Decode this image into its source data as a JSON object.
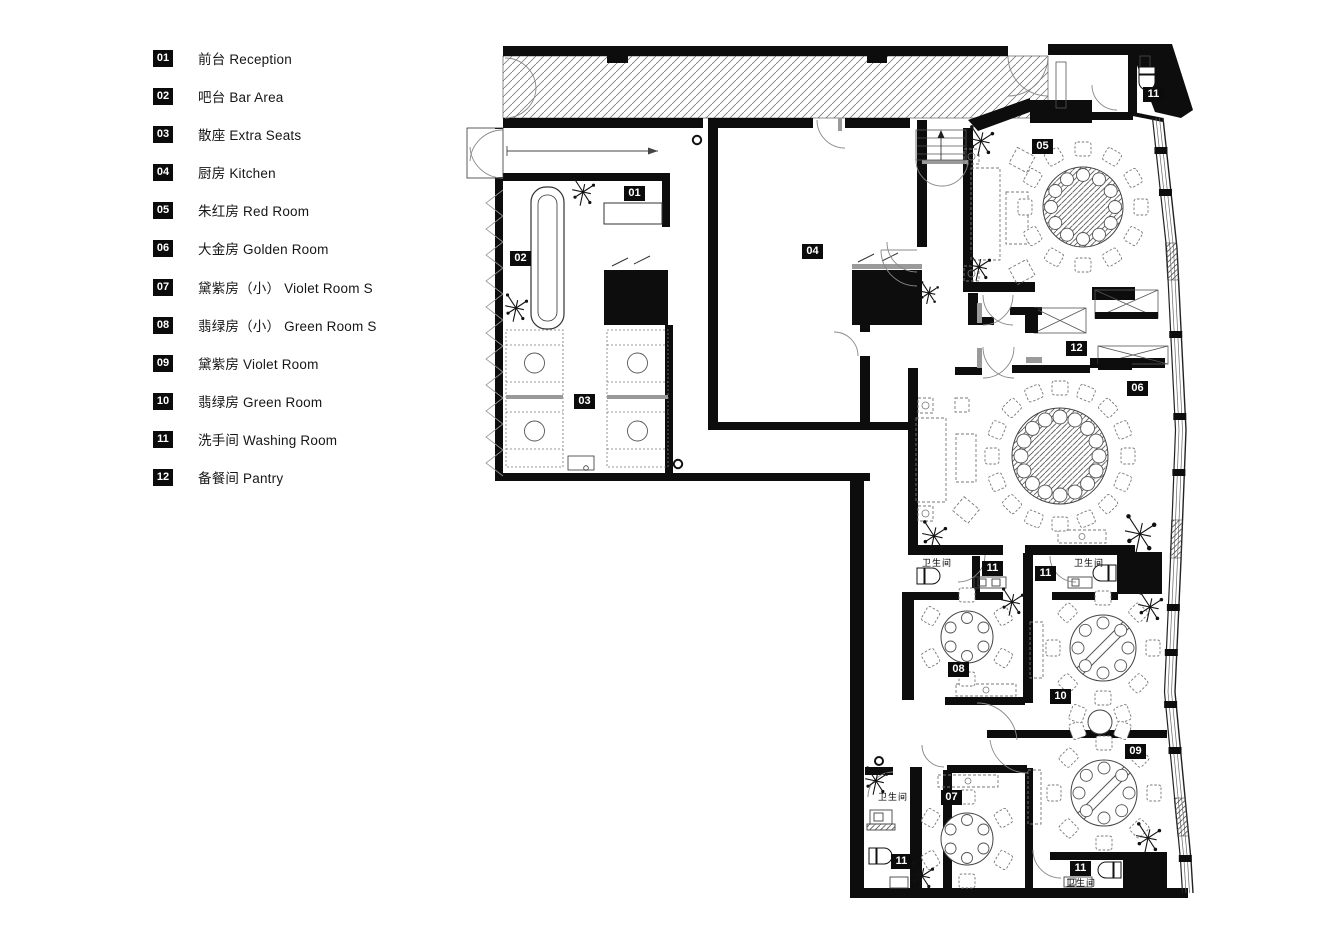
{
  "legend": {
    "items": [
      {
        "num": "01",
        "label": "前台 Reception"
      },
      {
        "num": "02",
        "label": "吧台 Bar Area"
      },
      {
        "num": "03",
        "label": "散座 Extra Seats"
      },
      {
        "num": "04",
        "label": "厨房 Kitchen"
      },
      {
        "num": "05",
        "label": "朱红房 Red Room"
      },
      {
        "num": "06",
        "label": "大金房 Golden Room"
      },
      {
        "num": "07",
        "label": "黛紫房（小） Violet Room S"
      },
      {
        "num": "08",
        "label": "翡绿房（小） Green Room S"
      },
      {
        "num": "09",
        "label": "黛紫房 Violet Room"
      },
      {
        "num": "10",
        "label": "翡绿房 Green Room"
      },
      {
        "num": "11",
        "label": "洗手间 Washing Room"
      },
      {
        "num": "12",
        "label": "备餐间 Pantry"
      }
    ]
  },
  "plan": {
    "badges": [
      {
        "id": "reception",
        "label": "01"
      },
      {
        "id": "bar-area",
        "label": "02"
      },
      {
        "id": "extra-seats",
        "label": "03"
      },
      {
        "id": "kitchen",
        "label": "04"
      },
      {
        "id": "red-room",
        "label": "05"
      },
      {
        "id": "golden-room",
        "label": "06"
      },
      {
        "id": "violet-room-s",
        "label": "07"
      },
      {
        "id": "green-room-s",
        "label": "08"
      },
      {
        "id": "violet-room",
        "label": "09"
      },
      {
        "id": "green-room",
        "label": "10"
      },
      {
        "id": "washing-room-ne",
        "label": "11"
      },
      {
        "id": "washing-room-mid-left",
        "label": "11"
      },
      {
        "id": "washing-room-mid-right",
        "label": "11"
      },
      {
        "id": "washing-room-sw",
        "label": "11"
      },
      {
        "id": "washing-room-se",
        "label": "11"
      },
      {
        "id": "pantry",
        "label": "12"
      }
    ],
    "wc": [
      "卫生间",
      "卫生间",
      "卫生间",
      "卫生间"
    ],
    "colors": {
      "wall": "#0d0d0d",
      "line": "#333333",
      "soft": "#777777",
      "hatch": "#555555",
      "background": "#ffffff"
    }
  }
}
